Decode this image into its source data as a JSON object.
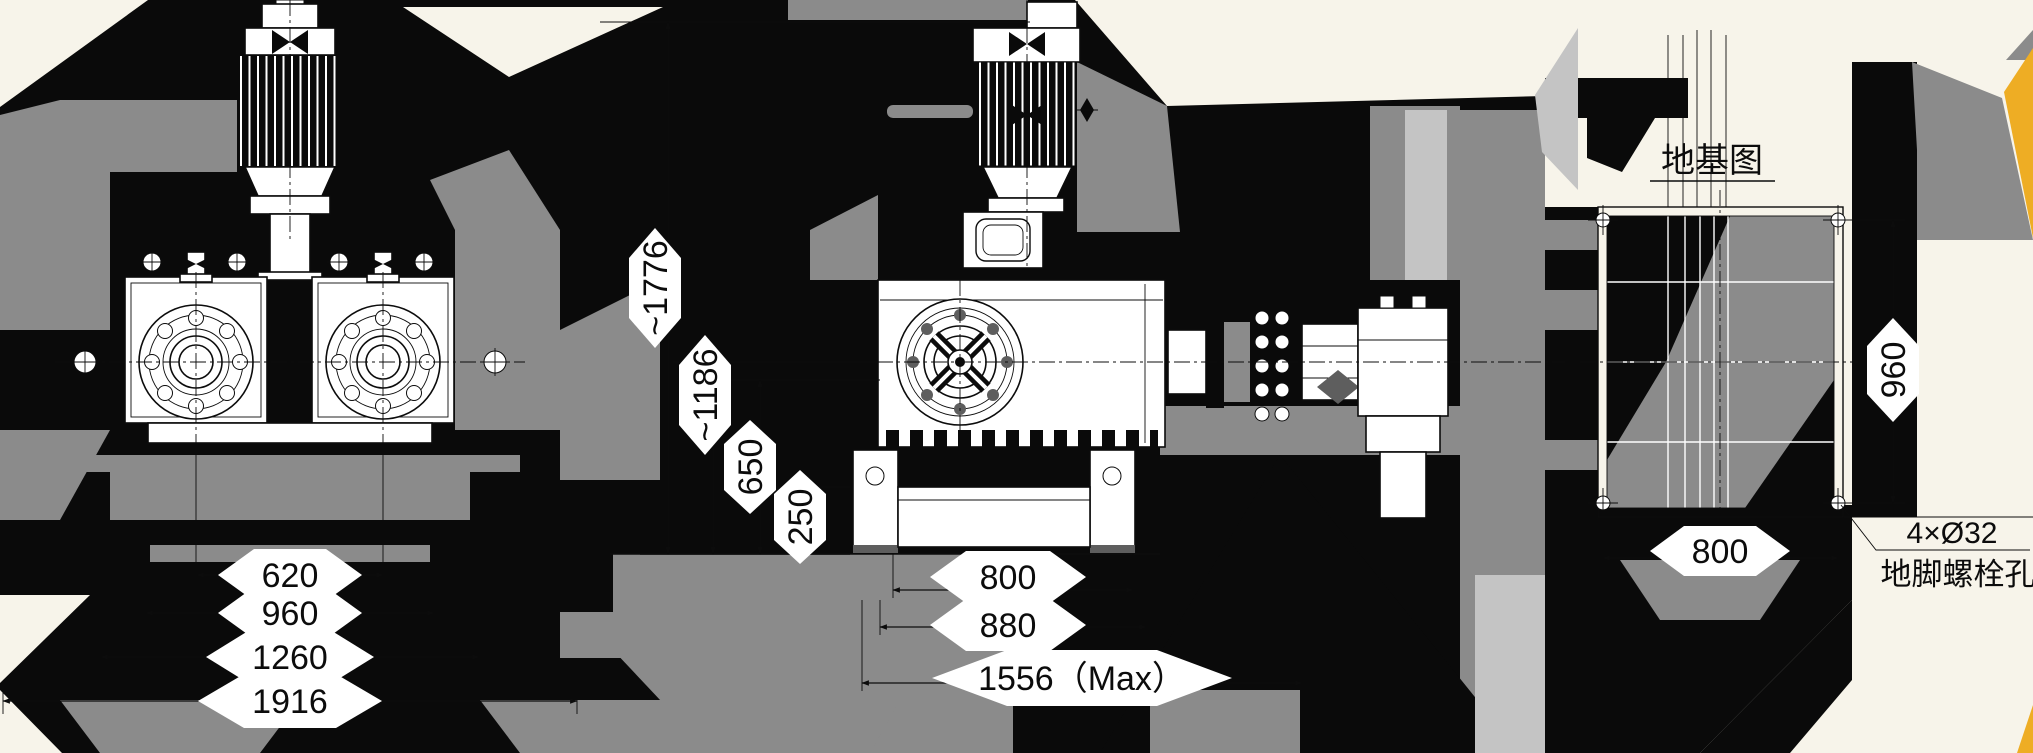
{
  "drawing": {
    "kind": "pump-unit-installation-and-foundation-drawing",
    "views": {
      "front": {
        "dims": {
          "pump_spacing": "620",
          "step1": "960",
          "step2": "1260",
          "overall": "1916"
        }
      },
      "side": {
        "vdims": {
          "overall_height": "~1776",
          "shaft_height": "~1186",
          "mid_height": "650",
          "base_height": "250"
        },
        "hdims": {
          "foot_span": "800",
          "base_span": "880",
          "overall_length": "1556（Max）"
        }
      },
      "foundation": {
        "title": "地基图",
        "height": "960",
        "width": "800",
        "bolt_note_spec": "4×Ø32",
        "bolt_note_label": "地脚螺栓孔"
      }
    },
    "colors": {
      "ink": "#0a0a0a",
      "gray": "#8b8b8b",
      "light_gray": "#c4c4c4",
      "dark_gray": "#5e5e5e",
      "cream": "#f7f4ea",
      "white": "#ffffff",
      "accent_yellow": "#eead24"
    }
  }
}
